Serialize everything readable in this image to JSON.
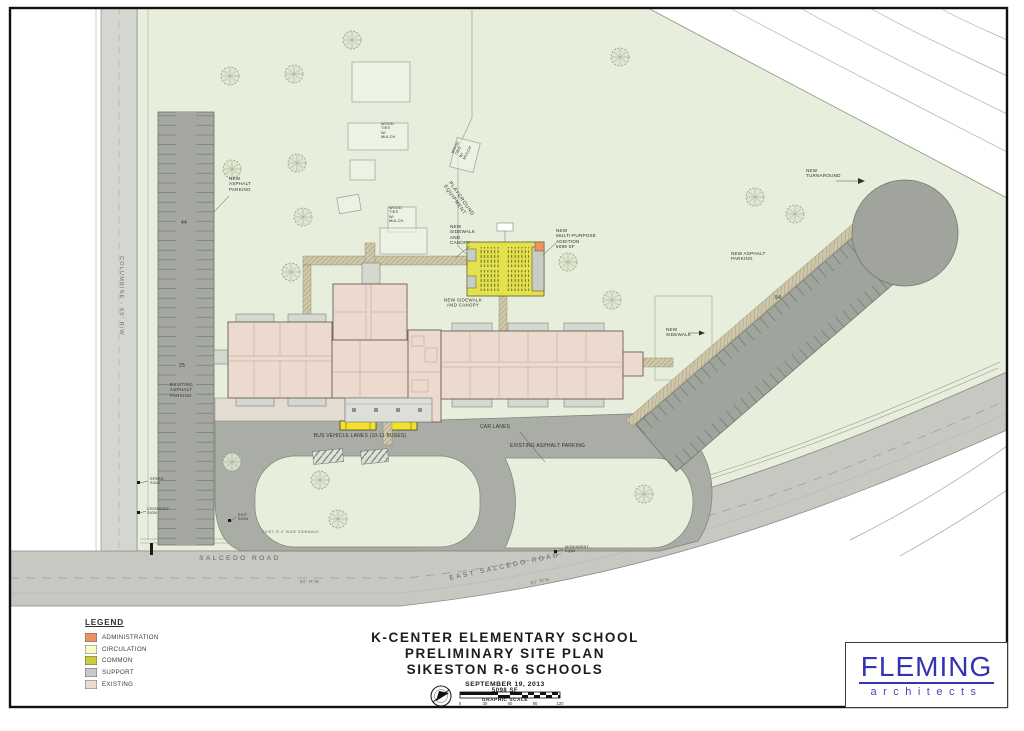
{
  "title_block": {
    "school": "K-CENTER ELEMENTARY SCHOOL",
    "line2": "PRELIMINARY SITE PLAN",
    "line3": "SIKESTON R-6 SCHOOLS",
    "date": "SEPTEMBER 19, 2013",
    "area": "5098 SF",
    "scale_label": "GRAPHIC SCALE",
    "scale_ticks": [
      "0",
      "30",
      "60",
      "90",
      "120"
    ]
  },
  "legend": {
    "heading": "LEGEND",
    "items": [
      {
        "label": "ADMINISTRATION",
        "color": "#ef9166"
      },
      {
        "label": "CIRCULATION",
        "color": "#fbf9c5"
      },
      {
        "label": "COMMON",
        "color": "#cbcc3d"
      },
      {
        "label": "SUPPORT",
        "color": "#c9c9c9"
      },
      {
        "label": "EXISTING",
        "color": "#e9dccf"
      }
    ]
  },
  "logo": {
    "firm": "FLEMING",
    "tagline": "architects",
    "color": "#3434b2"
  },
  "colors": {
    "site_green": "#e7efdc",
    "pavement_gray": "#a9ada5",
    "road_gray": "#c6c8c1",
    "existing_pink": "#eddacf",
    "common_yellow": "#e3e14e",
    "administration_orange": "#ef9166",
    "support_gray": "#c9c9c9",
    "bus_yellow": "#f3e12c",
    "logo_blue": "#3434b2"
  },
  "plan": {
    "labels": {
      "columbine": "COLUMBINE  -  60' R/W",
      "new_asphalt_parking_west": "NEW\nASPHALT\nPARKING",
      "count_44": "44",
      "existing_asphalt_parking_west": "EXISTING\nASPHALT\nPARKING",
      "count_25": "25",
      "playground_equipment": "PLAYGROUND\nEQUIPMENT",
      "wood_ties": "WOOD\nTIES\nW/\nMULCH",
      "new_sidewalk_canopy_north": "NEW\nSIDEWALK\nAND\nCANOPY",
      "new_multipurpose": "NEW\nMULTI-PURPOSE\nADDITION\n5099 SF",
      "new_sidewalk_canopy_south": "NEW SIDEWALK\nAND CANOPY",
      "new_turnaround": "NEW\nTURNAROUND",
      "new_asphalt_parking_east": "NEW ASPHALT\nPARKING",
      "count_54": "54",
      "new_sidewalk": "NEW\nSIDEWALK",
      "bus_lanes": "BUS VEHICLE LANES (10-11 BUSES)",
      "car_lanes": "CAR LANES",
      "existing_asphalt_parking_center": "EXISTING ASPHALT PARKING",
      "speed_sign": "SPEED\nSIGN",
      "crossing_sign": "CROSSING\nSIGN",
      "exit_sign": "EXIT\nSIGN",
      "monument_sign": "MONUMENT\nSIGN",
      "sidewalk_note": "EXIST. 5'-0\" WIDE SIDEWALK",
      "salcedo_road": "SALCEDO  ROAD",
      "salcedo_rw": "60' R/W",
      "east_salcedo_road": "EAST  SALCEDO  ROAD",
      "east_salcedo_rw": "60' R/W"
    }
  }
}
